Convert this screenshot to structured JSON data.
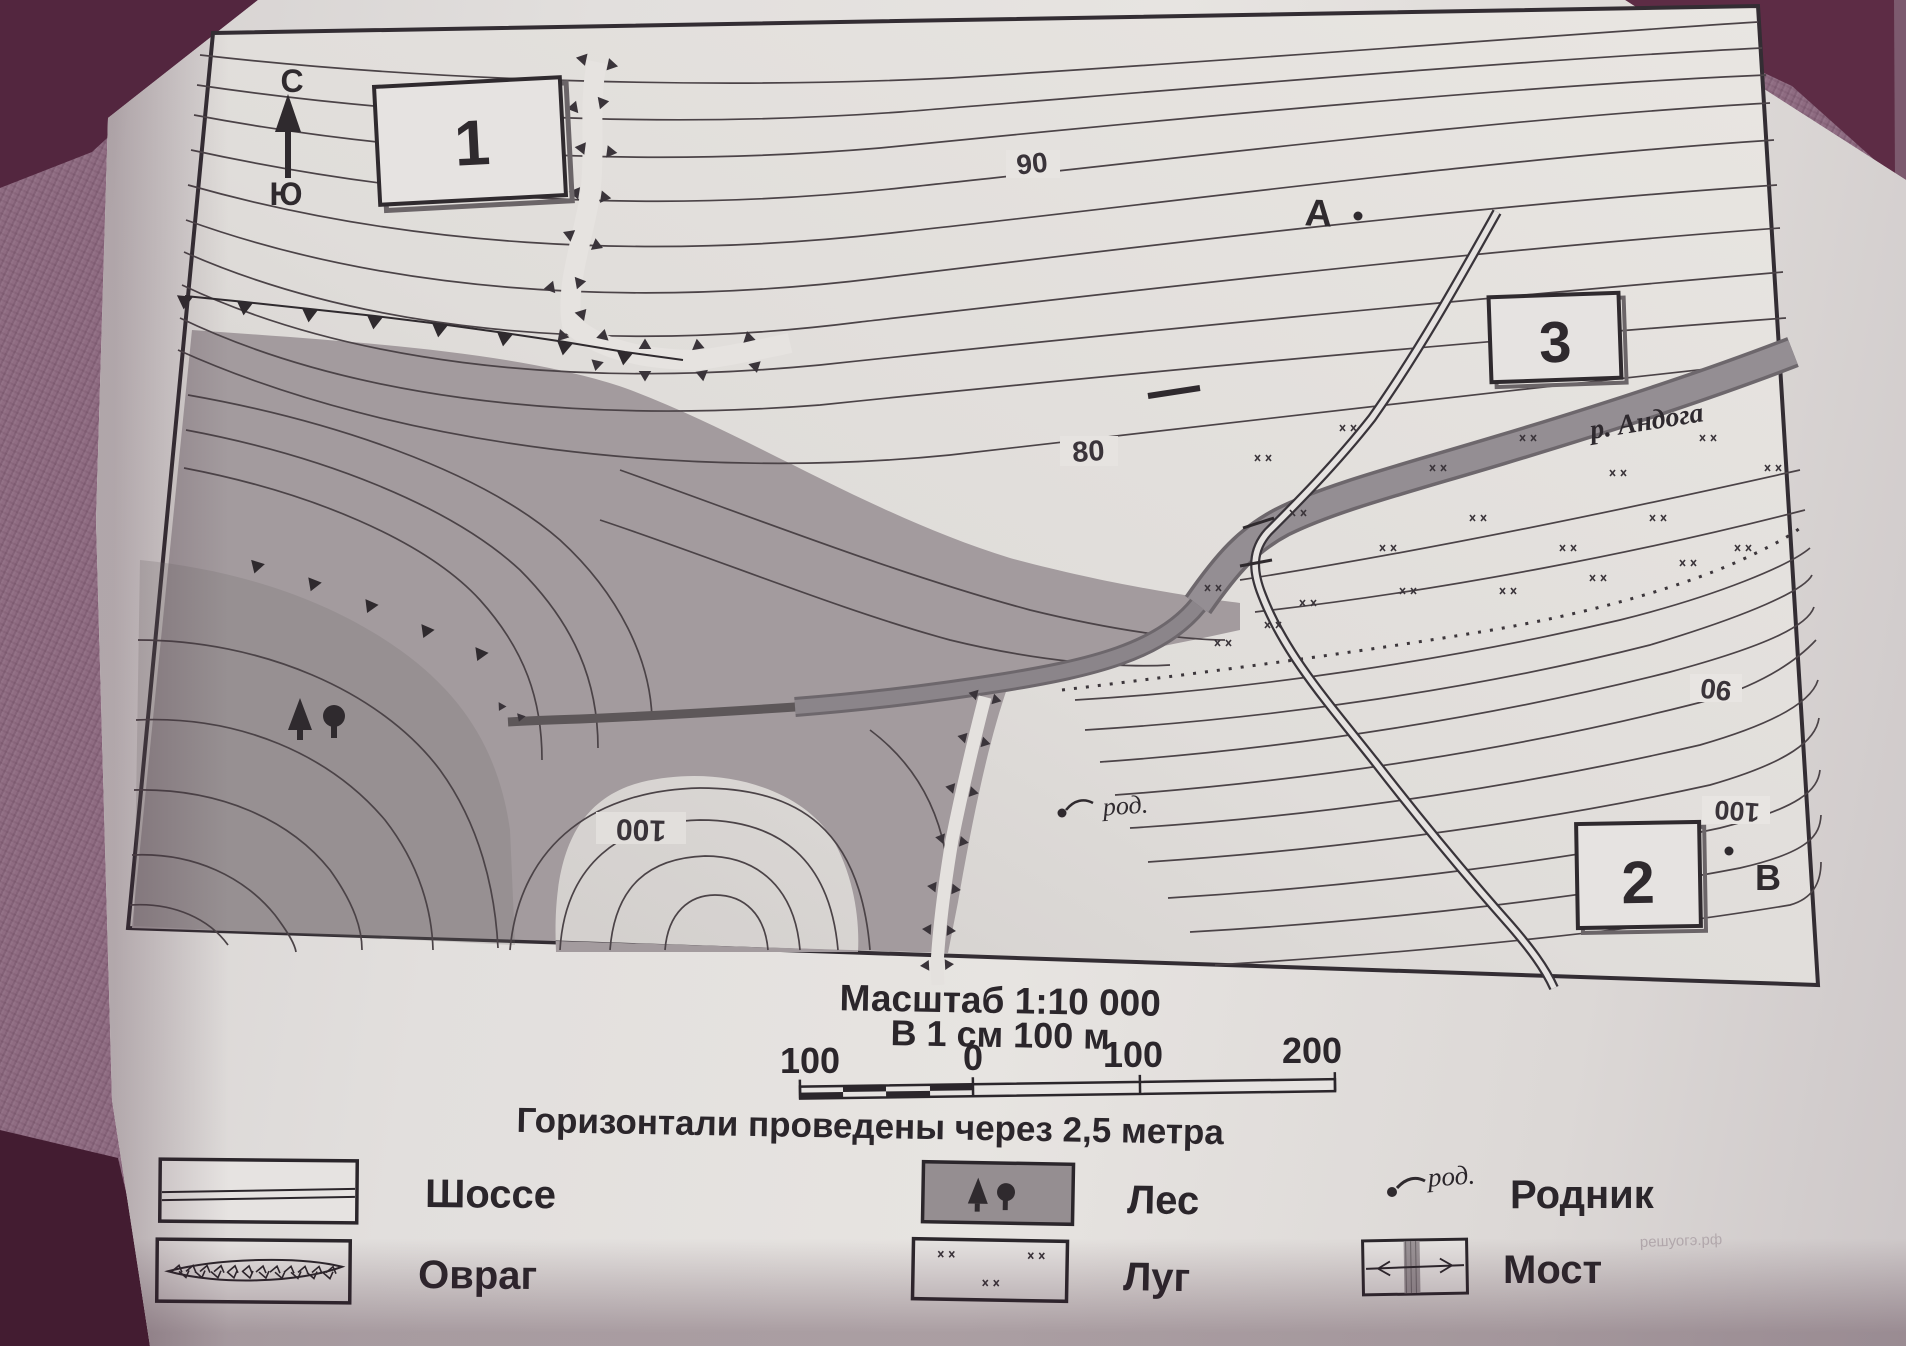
{
  "map": {
    "compass": {
      "north": "С",
      "south": "Ю"
    },
    "markers": {
      "square1": "1",
      "square2": "2",
      "square3": "3",
      "pointA": "А",
      "pointB": "В"
    },
    "contour_labels": {
      "c90_top": "90",
      "c80_mid": "80",
      "c100_hill": "100",
      "c90_right": "90",
      "c100_right": "100"
    },
    "river_label": "р. Андога",
    "spring_label": "род."
  },
  "scale": {
    "title": "Масштаб 1:10 000",
    "subtitle": "В 1 см 100 м",
    "bar_labels": [
      "100",
      "0",
      "100",
      "200"
    ],
    "note": "Горизонтали проведены через 2,5 метра"
  },
  "legend": {
    "items": [
      {
        "label": "Шоссе",
        "symbol": "highway"
      },
      {
        "label": "Овраг",
        "symbol": "ravine"
      },
      {
        "label": "Лес",
        "symbol": "forest"
      },
      {
        "label": "Луг",
        "symbol": "meadow"
      },
      {
        "label": "Родник",
        "symbol": "spring",
        "symbol_text": "род."
      },
      {
        "label": "Мост",
        "symbol": "bridge"
      }
    ]
  },
  "watermark": "решуогэ.рф"
}
